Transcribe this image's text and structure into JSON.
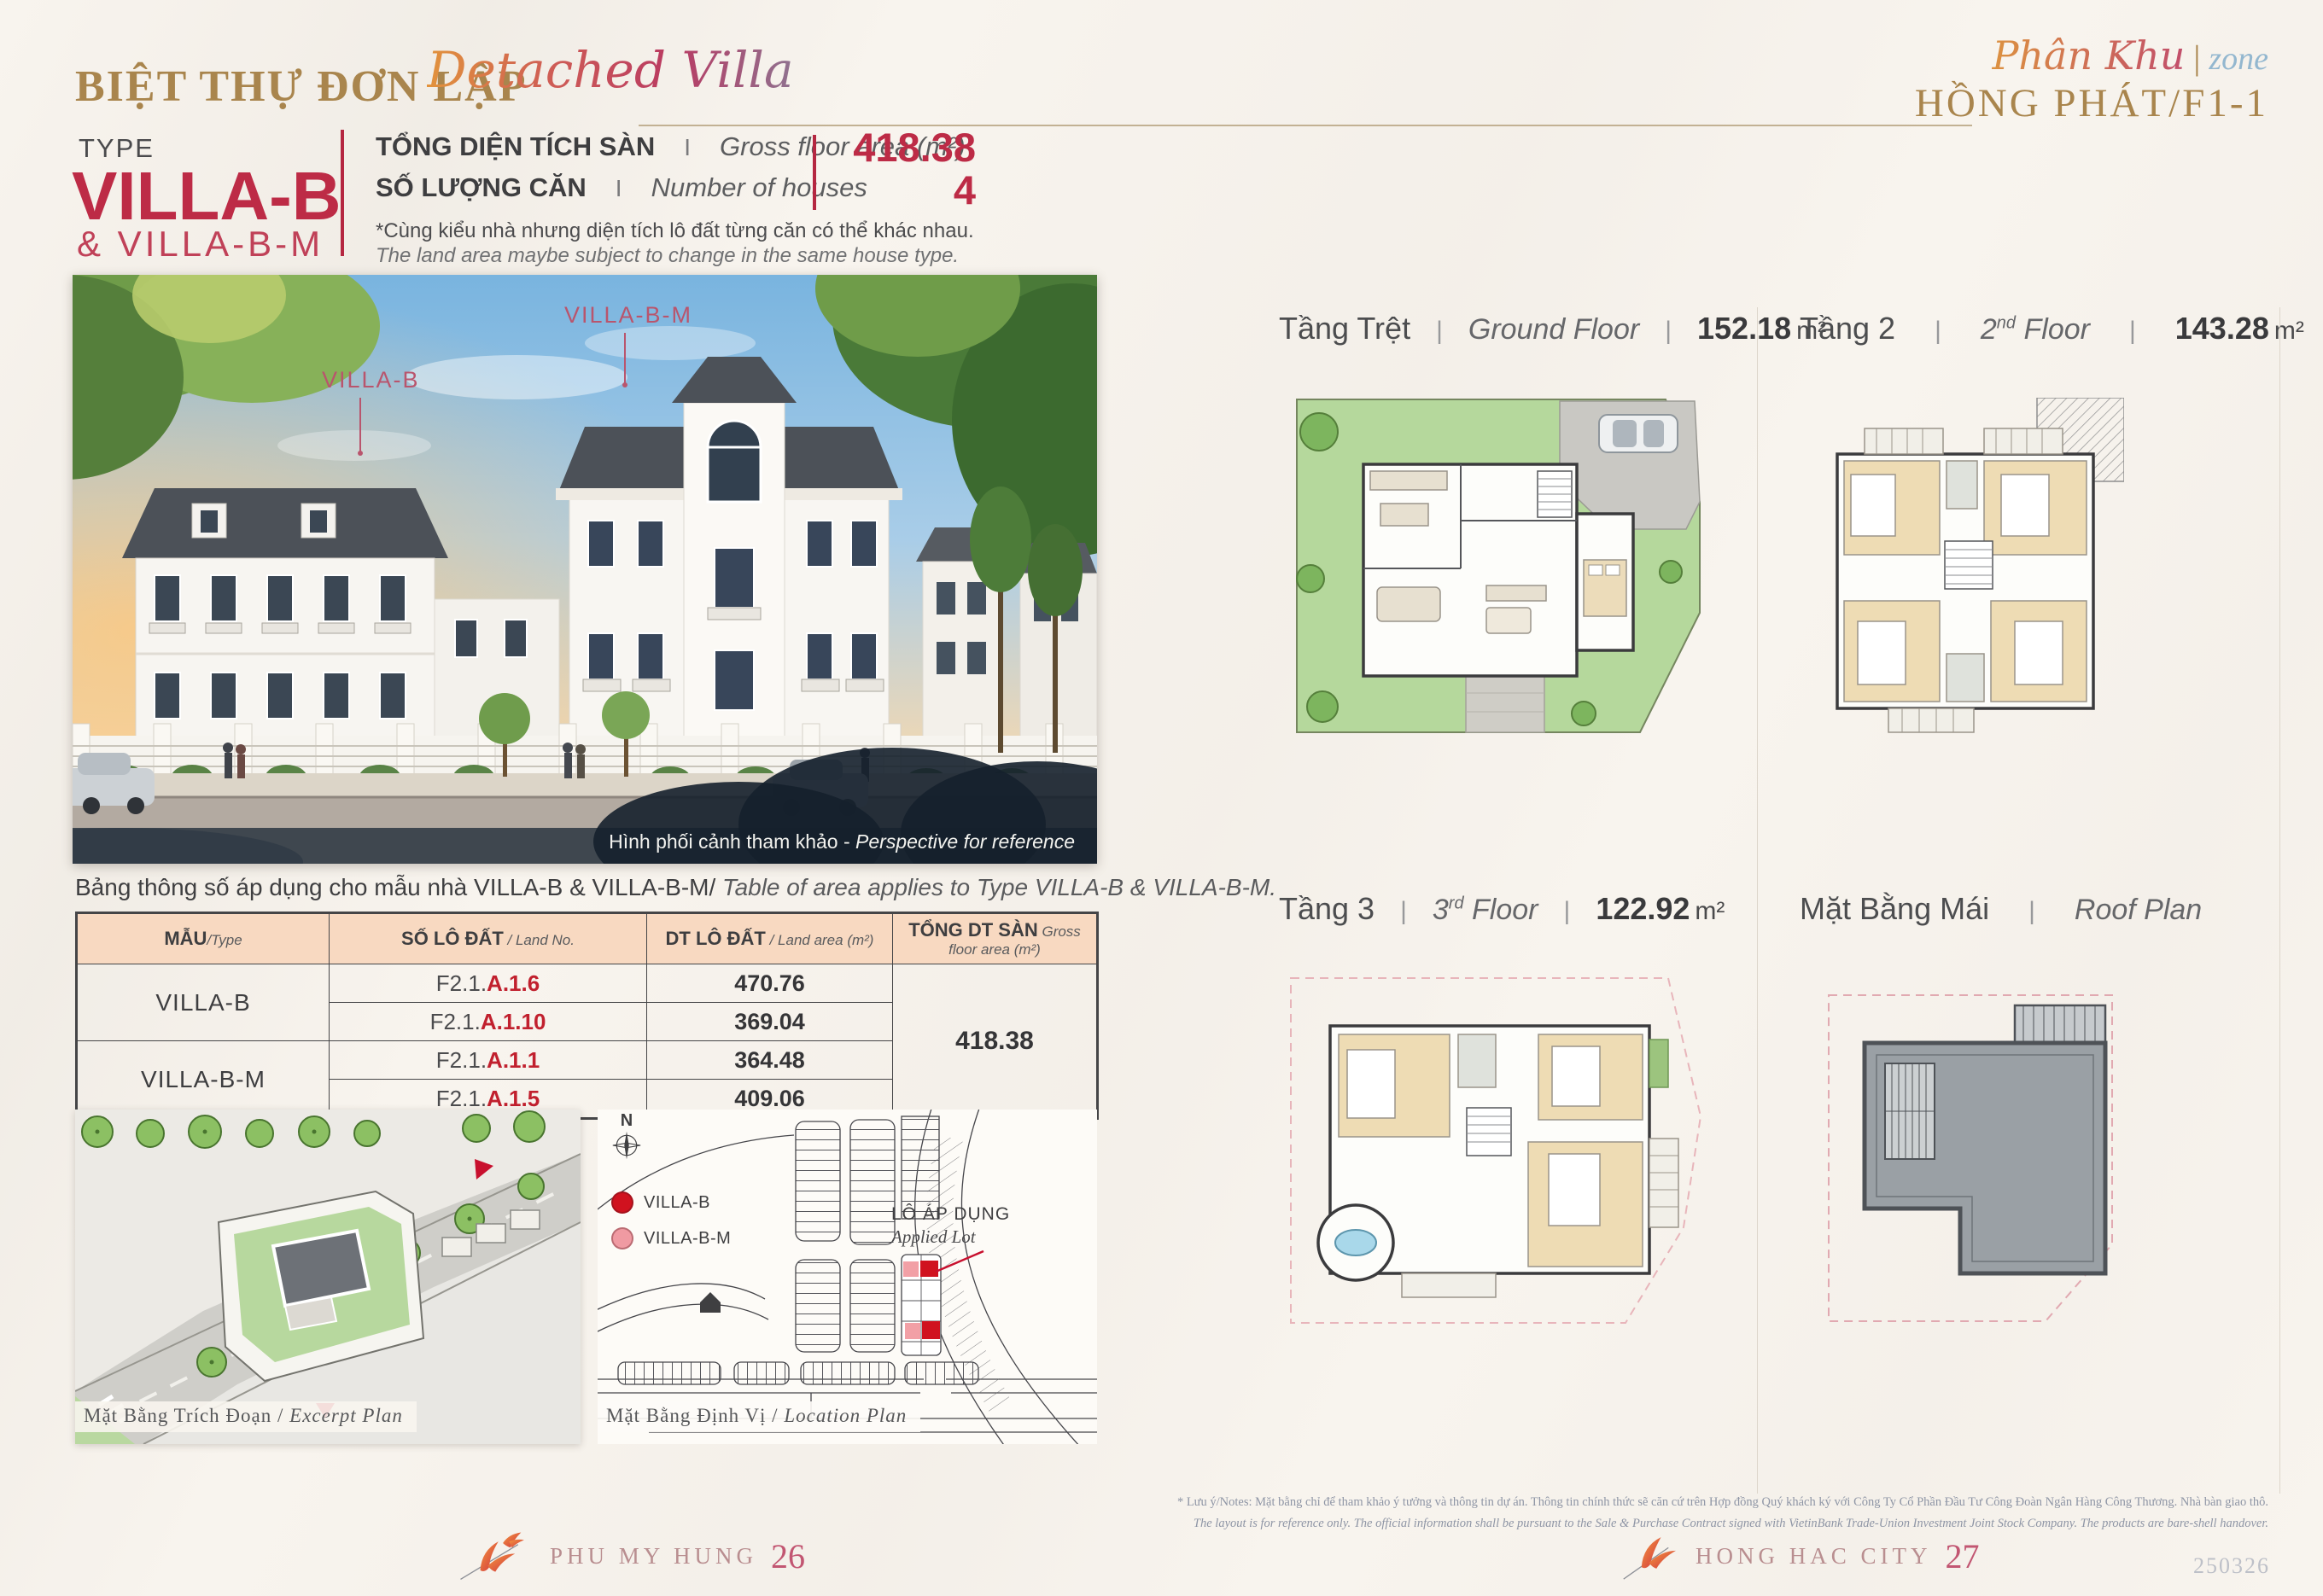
{
  "ui": {
    "pipe": "|",
    "sep_i": "I"
  },
  "header": {
    "title_vi": "BIỆT THỰ ĐƠN LẬP",
    "title_script": "Detached Villa",
    "zone_script": "Phân Khu",
    "zone_en": "zone",
    "zone_name": "HỒNG PHÁT/F1-1"
  },
  "type_block": {
    "label": "TYPE",
    "name": "VILLA-B",
    "subname": "& VILLA-B-M"
  },
  "stats": {
    "gfa": {
      "vi": "TỔNG DIỆN TÍCH SÀN",
      "en": "Gross floor area (m²)",
      "value": "418.38"
    },
    "houses": {
      "vi": "SỐ LƯỢNG CĂN",
      "en": "Number of houses",
      "value": "4"
    },
    "note_vi": "*Cùng kiểu nhà nhưng diện tích lô đất từng căn có thể khác nhau.",
    "note_en": "The land area maybe subject to change in the same house type."
  },
  "perspective": {
    "label_villa_b": "VILLA-B",
    "label_villa_b_m": "VILLA-B-M",
    "caption_vi": "Hình phối cảnh tham khảo - ",
    "caption_en": "Perspective for reference"
  },
  "area_table": {
    "caption_vi": "Bảng thông số áp dụng cho mẫu nhà VILLA-B & VILLA-B-M/",
    "caption_en": " Table of area applies to Type VILLA-B & VILLA-B-M.",
    "headers": [
      {
        "vi": "MẪU",
        "en": "/Type"
      },
      {
        "vi": "SỐ LÔ ĐẤT",
        "en": " / Land No."
      },
      {
        "vi": "DT LÔ ĐẤT",
        "en": " / Land area (m²)"
      },
      {
        "vi": "TỔNG DT SÀN",
        "en": " Gross floor area (m²)"
      }
    ],
    "groups": [
      {
        "type": "VILLA-B",
        "lots": [
          {
            "prefix": "F2.1.",
            "code": "A.1.6",
            "area": "470.76"
          },
          {
            "prefix": "F2.1.",
            "code": "A.1.10",
            "area": "369.04"
          }
        ]
      },
      {
        "type": "VILLA-B-M",
        "lots": [
          {
            "prefix": "F2.1.",
            "code": "A.1.1",
            "area": "364.48"
          },
          {
            "prefix": "F2.1.",
            "code": "A.1.5",
            "area": "409.06"
          }
        ]
      }
    ],
    "total_gfa": "418.38"
  },
  "site_plans": {
    "excerpt_caption_vi": "Mặt Bằng Trích Đoạn /",
    "excerpt_caption_en": " Excerpt Plan",
    "location_caption_vi": "Mặt Bằng Định Vị /",
    "location_caption_en": " Location Plan",
    "compass_label": "N",
    "legend": [
      {
        "label": "VILLA-B",
        "color": "#d0121f"
      },
      {
        "label": "VILLA-B-M",
        "color": "#f09aa2"
      }
    ],
    "applied_lot_vi": "LÔ ÁP DỤNG",
    "applied_lot_en": "Applied Lot"
  },
  "floor_plans": [
    {
      "vi": "Tầng Trệt",
      "en_pre": "Ground Floor",
      "en_sup": "",
      "en_post": "",
      "area": "152.18",
      "unit": "m²"
    },
    {
      "vi": "Tầng 2",
      "en_pre": "2",
      "en_sup": "nd",
      "en_post": " Floor",
      "area": "143.28",
      "unit": "m²"
    },
    {
      "vi": "Tầng 3",
      "en_pre": "3",
      "en_sup": "rd",
      "en_post": " Floor",
      "area": "122.92",
      "unit": "m²"
    },
    {
      "vi": "Mặt Bằng Mái",
      "en_pre": "Roof Plan",
      "en_sup": "",
      "en_post": "",
      "area": "",
      "unit": ""
    }
  ],
  "footer": {
    "note_vi": "* Lưu ý/Notes: Mặt bằng chỉ để tham khảo ý tưởng và thông tin dự án. Thông tin chính thức sẽ căn cứ trên Hợp đồng Quý khách ký với Công Ty Cổ Phần Đầu Tư Công Đoàn Ngân Hàng Công Thương. Nhà bàn giao thô.",
    "note_en": "The layout is for reference only. The official information shall be pursuant to the Sale & Purchase Contract signed with VietinBank Trade-Union Investment Joint Stock Company. The products are bare-shell handover.",
    "brand_left": "PHU MY HUNG",
    "page_left": "26",
    "brand_right": "HONG HAC CITY",
    "page_right": "27",
    "doc_code": "250326"
  }
}
